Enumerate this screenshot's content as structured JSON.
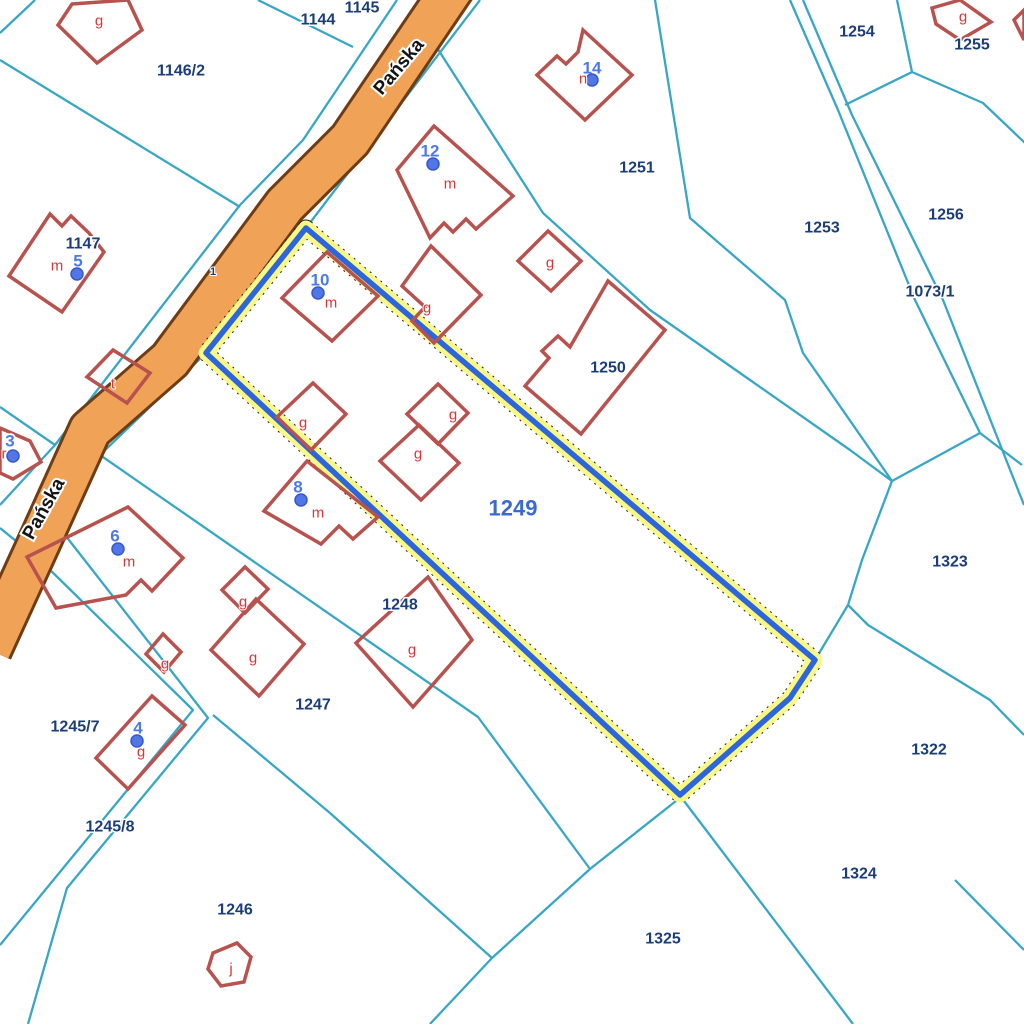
{
  "map": {
    "title": "Cadastral parcel map",
    "background": "#ffffff",
    "colors": {
      "boundary": "#38a7c4",
      "road_fill": "#f0a257",
      "road_casing": "#6e3c15",
      "building": "#b7524e",
      "building_letter": "#d63737",
      "parcel_text": "#1c3e78",
      "address_text": "#4d79ea",
      "dot_fill": "#5076e8",
      "dot_stroke": "#3757c9",
      "highlight_halo": "#f9f885",
      "highlight_line": "#2d65dd",
      "highlight_dash": "#222222",
      "selected_text": "#3a6ad0",
      "road_text": "#141414"
    },
    "road": {
      "name": "Pańska",
      "centerline": [
        [
          455,
          -15
        ],
        [
          350,
          140
        ],
        [
          285,
          205
        ],
        [
          170,
          360
        ],
        [
          90,
          430
        ],
        [
          38,
          545
        ],
        [
          -10,
          650
        ]
      ],
      "width": 40,
      "casing_width": 46,
      "labels": [
        {
          "text": "Pańska",
          "x": 399,
          "y": 67,
          "rotation": -50
        },
        {
          "text": "Pańska",
          "x": 44,
          "y": 509,
          "rotation": -61
        }
      ]
    },
    "boundaries": [
      {
        "points": [
          [
            35,
            0
          ],
          [
            0,
            33
          ]
        ]
      },
      {
        "points": [
          [
            258,
            0
          ],
          [
            353,
            47
          ]
        ]
      },
      {
        "points": [
          [
            397,
            0
          ],
          [
            303,
            140
          ],
          [
            240,
            205
          ],
          [
            132,
            345
          ],
          [
            55,
            445
          ],
          [
            0,
            505
          ]
        ]
      },
      {
        "points": [
          [
            0,
            60
          ],
          [
            240,
            207
          ]
        ]
      },
      {
        "points": [
          [
            0,
            407
          ],
          [
            55,
            445
          ]
        ]
      },
      {
        "points": [
          [
            480,
            0
          ],
          [
            306,
            228
          ],
          [
            206,
            353
          ],
          [
            100,
            455
          ],
          [
            52,
            560
          ],
          [
            0,
            607
          ]
        ]
      },
      {
        "points": [
          [
            432,
            40
          ],
          [
            543,
            213
          ],
          [
            650,
            310
          ],
          [
            750,
            380
          ],
          [
            850,
            450
          ],
          [
            892,
            481
          ]
        ]
      },
      {
        "points": [
          [
            655,
            0
          ],
          [
            690,
            218
          ],
          [
            785,
            300
          ],
          [
            803,
            353
          ],
          [
            892,
            481
          ]
        ]
      },
      {
        "points": [
          [
            790,
            0
          ],
          [
            838,
            110
          ],
          [
            915,
            300
          ],
          [
            980,
            433
          ],
          [
            1022,
            465
          ]
        ]
      },
      {
        "points": [
          [
            803,
            0
          ],
          [
            852,
            115
          ],
          [
            943,
            300
          ],
          [
            1024,
            505
          ]
        ]
      },
      {
        "points": [
          [
            897,
            0
          ],
          [
            912,
            72
          ]
        ]
      },
      {
        "points": [
          [
            912,
            72
          ],
          [
            845,
            105
          ]
        ]
      },
      {
        "points": [
          [
            912,
            72
          ],
          [
            983,
            103
          ],
          [
            1025,
            143
          ]
        ]
      },
      {
        "points": [
          [
            892,
            481
          ],
          [
            980,
            433
          ]
        ]
      },
      {
        "points": [
          [
            892,
            481
          ],
          [
            862,
            560
          ],
          [
            848,
            605
          ]
        ]
      },
      {
        "points": [
          [
            848,
            605
          ],
          [
            818,
            655
          ]
        ]
      },
      {
        "points": [
          [
            848,
            605
          ],
          [
            868,
            625
          ],
          [
            990,
            700
          ],
          [
            1024,
            735
          ]
        ]
      },
      {
        "points": [
          [
            955,
            880
          ],
          [
            1024,
            950
          ]
        ]
      },
      {
        "points": [
          [
            681,
            797
          ],
          [
            853,
            1024
          ]
        ]
      },
      {
        "points": [
          [
            681,
            797
          ],
          [
            590,
            869
          ],
          [
            492,
            958
          ]
        ]
      },
      {
        "points": [
          [
            492,
            958
          ],
          [
            430,
            1024
          ]
        ]
      },
      {
        "points": [
          [
            213,
            715
          ],
          [
            330,
            813
          ],
          [
            492,
            958
          ]
        ]
      },
      {
        "points": [
          [
            100,
            455
          ],
          [
            478,
            717
          ],
          [
            590,
            869
          ]
        ]
      },
      {
        "points": [
          [
            0,
            528
          ],
          [
            43,
            563
          ],
          [
            193,
            710
          ],
          [
            0,
            945
          ]
        ]
      },
      {
        "points": [
          [
            58,
            526
          ],
          [
            208,
            718
          ],
          [
            67,
            888
          ],
          [
            28,
            1024
          ]
        ]
      }
    ],
    "highlight_parcel": {
      "id": "1249",
      "points": [
        [
          306,
          228
        ],
        [
          206,
          353
        ],
        [
          680,
          795
        ],
        [
          790,
          698
        ],
        [
          815,
          660
        ]
      ],
      "label": {
        "text": "1249",
        "x": 513,
        "y": 508
      }
    },
    "buildings": [
      {
        "points": [
          [
            72,
            4
          ],
          [
            128,
            0
          ],
          [
            142,
            30
          ],
          [
            97,
            63
          ],
          [
            58,
            25
          ]
        ]
      },
      {
        "points": [
          [
            583,
            30
          ],
          [
            632,
            75
          ],
          [
            585,
            120
          ],
          [
            537,
            75
          ],
          [
            557,
            56
          ],
          [
            566,
            64
          ],
          [
            578,
            52
          ]
        ]
      },
      {
        "points": [
          [
            434,
            126
          ],
          [
            513,
            196
          ],
          [
            476,
            229
          ],
          [
            466,
            219
          ],
          [
            453,
            232
          ],
          [
            444,
            223
          ],
          [
            430,
            238
          ],
          [
            397,
            170
          ]
        ]
      },
      {
        "points": [
          [
            548,
            231
          ],
          [
            581,
            261
          ],
          [
            551,
            291
          ],
          [
            518,
            261
          ]
        ]
      },
      {
        "points": [
          [
            608,
            281
          ],
          [
            665,
            330
          ],
          [
            581,
            434
          ],
          [
            525,
            386
          ],
          [
            549,
            358
          ],
          [
            542,
            351
          ],
          [
            558,
            336
          ],
          [
            570,
            347
          ]
        ]
      },
      {
        "points": [
          [
            327,
            252
          ],
          [
            378,
            296
          ],
          [
            332,
            341
          ],
          [
            282,
            298
          ]
        ]
      },
      {
        "points": [
          [
            431,
            246
          ],
          [
            481,
            295
          ],
          [
            434,
            343
          ],
          [
            412,
            321
          ],
          [
            425,
            307
          ],
          [
            402,
            286
          ]
        ]
      },
      {
        "points": [
          [
            313,
            383
          ],
          [
            346,
            414
          ],
          [
            311,
            450
          ],
          [
            277,
            417
          ]
        ]
      },
      {
        "points": [
          [
            438,
            384
          ],
          [
            468,
            413
          ],
          [
            438,
            444
          ],
          [
            407,
            414
          ]
        ]
      },
      {
        "points": [
          [
            419,
            425
          ],
          [
            459,
            463
          ],
          [
            421,
            500
          ],
          [
            380,
            461
          ]
        ]
      },
      {
        "points": [
          [
            307,
            461
          ],
          [
            378,
            517
          ],
          [
            353,
            539
          ],
          [
            339,
            526
          ],
          [
            321,
            544
          ],
          [
            264,
            511
          ]
        ]
      },
      {
        "points": [
          [
            128,
            507
          ],
          [
            183,
            558
          ],
          [
            152,
            591
          ],
          [
            141,
            580
          ],
          [
            126,
            595
          ],
          [
            56,
            608
          ],
          [
            27,
            557
          ]
        ]
      },
      {
        "points": [
          [
            50,
            214
          ],
          [
            62,
            226
          ],
          [
            71,
            216
          ],
          [
            89,
            233
          ],
          [
            104,
            252
          ],
          [
            62,
            312
          ],
          [
            9,
            276
          ]
        ]
      },
      {
        "points": [
          [
            113,
            350
          ],
          [
            150,
            373
          ],
          [
            127,
            403
          ],
          [
            87,
            377
          ]
        ]
      },
      {
        "points": [
          [
            0,
            428
          ],
          [
            30,
            441
          ],
          [
            41,
            462
          ],
          [
            13,
            479
          ],
          [
            0,
            473
          ]
        ]
      },
      {
        "points": [
          [
            152,
            696
          ],
          [
            185,
            725
          ],
          [
            128,
            789
          ],
          [
            96,
            758
          ]
        ]
      },
      {
        "points": [
          [
            245,
            567
          ],
          [
            268,
            589
          ],
          [
            245,
            613
          ],
          [
            222,
            590
          ]
        ]
      },
      {
        "points": [
          [
            256,
            599
          ],
          [
            304,
            644
          ],
          [
            259,
            696
          ],
          [
            211,
            650
          ]
        ]
      },
      {
        "points": [
          [
            163,
            634
          ],
          [
            181,
            652
          ],
          [
            164,
            672
          ],
          [
            146,
            654
          ]
        ]
      },
      {
        "points": [
          [
            428,
            577
          ],
          [
            472,
            640
          ],
          [
            413,
            707
          ],
          [
            356,
            643
          ]
        ]
      },
      {
        "points": [
          [
            213,
            953
          ],
          [
            237,
            943
          ],
          [
            251,
            957
          ],
          [
            244,
            982
          ],
          [
            221,
            986
          ],
          [
            208,
            969
          ]
        ]
      },
      {
        "points": [
          [
            932,
            8
          ],
          [
            960,
            0
          ],
          [
            991,
            22
          ],
          [
            960,
            40
          ],
          [
            936,
            24
          ]
        ]
      },
      {
        "points": [
          [
            1024,
            10
          ],
          [
            1014,
            20
          ],
          [
            1024,
            40
          ]
        ]
      }
    ],
    "parcel_labels": [
      {
        "text": "1144",
        "x": 318,
        "y": 20
      },
      {
        "text": "1145",
        "x": 362,
        "y": 8
      },
      {
        "text": "1146/2",
        "x": 181,
        "y": 71
      },
      {
        "text": "1147",
        "x": 83,
        "y": 244
      },
      {
        "text": "1251",
        "x": 637,
        "y": 168
      },
      {
        "text": "1254",
        "x": 857,
        "y": 32
      },
      {
        "text": "1255",
        "x": 972,
        "y": 45
      },
      {
        "text": "1253",
        "x": 822,
        "y": 228
      },
      {
        "text": "1256",
        "x": 946,
        "y": 215
      },
      {
        "text": "1073/1",
        "x": 930,
        "y": 292
      },
      {
        "text": "1250",
        "x": 608,
        "y": 368
      },
      {
        "text": "1323",
        "x": 950,
        "y": 562
      },
      {
        "text": "1248",
        "x": 400,
        "y": 605
      },
      {
        "text": "1247",
        "x": 313,
        "y": 705
      },
      {
        "text": "1245/7",
        "x": 75,
        "y": 727
      },
      {
        "text": "1322",
        "x": 929,
        "y": 750
      },
      {
        "text": "1245/8",
        "x": 110,
        "y": 827
      },
      {
        "text": "1324",
        "x": 859,
        "y": 874
      },
      {
        "text": "1246",
        "x": 235,
        "y": 910
      },
      {
        "text": "1325",
        "x": 663,
        "y": 939
      },
      {
        "text": "1",
        "x": 213,
        "y": 272,
        "tiny": true
      }
    ],
    "address_points": [
      {
        "number": "14",
        "x": 592,
        "y": 68,
        "dot": [
          592,
          80
        ],
        "letter": {
          "text": "n",
          "x": 583,
          "y": 79
        }
      },
      {
        "number": "12",
        "x": 430,
        "y": 151,
        "dot": [
          433,
          164
        ],
        "letter": {
          "text": "m",
          "x": 450,
          "y": 184
        }
      },
      {
        "number": "10",
        "x": 320,
        "y": 280,
        "dot": [
          318,
          293
        ],
        "letter": {
          "text": "m",
          "x": 331,
          "y": 303
        }
      },
      {
        "number": "8",
        "x": 298,
        "y": 487,
        "dot": [
          301,
          500
        ],
        "letter": {
          "text": "m",
          "x": 318,
          "y": 513
        }
      },
      {
        "number": "6",
        "x": 115,
        "y": 536,
        "dot": [
          118,
          549
        ],
        "letter": {
          "text": "m",
          "x": 129,
          "y": 562
        }
      },
      {
        "number": "5",
        "x": 78,
        "y": 261,
        "dot": [
          77,
          274
        ],
        "letter": {
          "text": "m",
          "x": 57,
          "y": 266
        }
      },
      {
        "number": "4",
        "x": 138,
        "y": 728,
        "dot": [
          137,
          741
        ],
        "letter": {
          "text": "g",
          "x": 141,
          "y": 752
        }
      },
      {
        "number": "3",
        "x": 10,
        "y": 441,
        "dot": [
          13,
          456
        ],
        "letter": {
          "text": "r",
          "x": 4,
          "y": 454
        }
      }
    ],
    "building_letters": [
      {
        "text": "g",
        "x": 99,
        "y": 21
      },
      {
        "text": "g",
        "x": 963,
        "y": 17
      },
      {
        "text": "g",
        "x": 550,
        "y": 263
      },
      {
        "text": "g",
        "x": 427,
        "y": 308
      },
      {
        "text": "g",
        "x": 303,
        "y": 423
      },
      {
        "text": "g",
        "x": 453,
        "y": 415
      },
      {
        "text": "g",
        "x": 418,
        "y": 454
      },
      {
        "text": "t",
        "x": 113,
        "y": 384
      },
      {
        "text": "g",
        "x": 243,
        "y": 602
      },
      {
        "text": "g",
        "x": 253,
        "y": 658
      },
      {
        "text": "g",
        "x": 165,
        "y": 664
      },
      {
        "text": "g",
        "x": 412,
        "y": 650
      },
      {
        "text": "j",
        "x": 231,
        "y": 969
      }
    ]
  }
}
